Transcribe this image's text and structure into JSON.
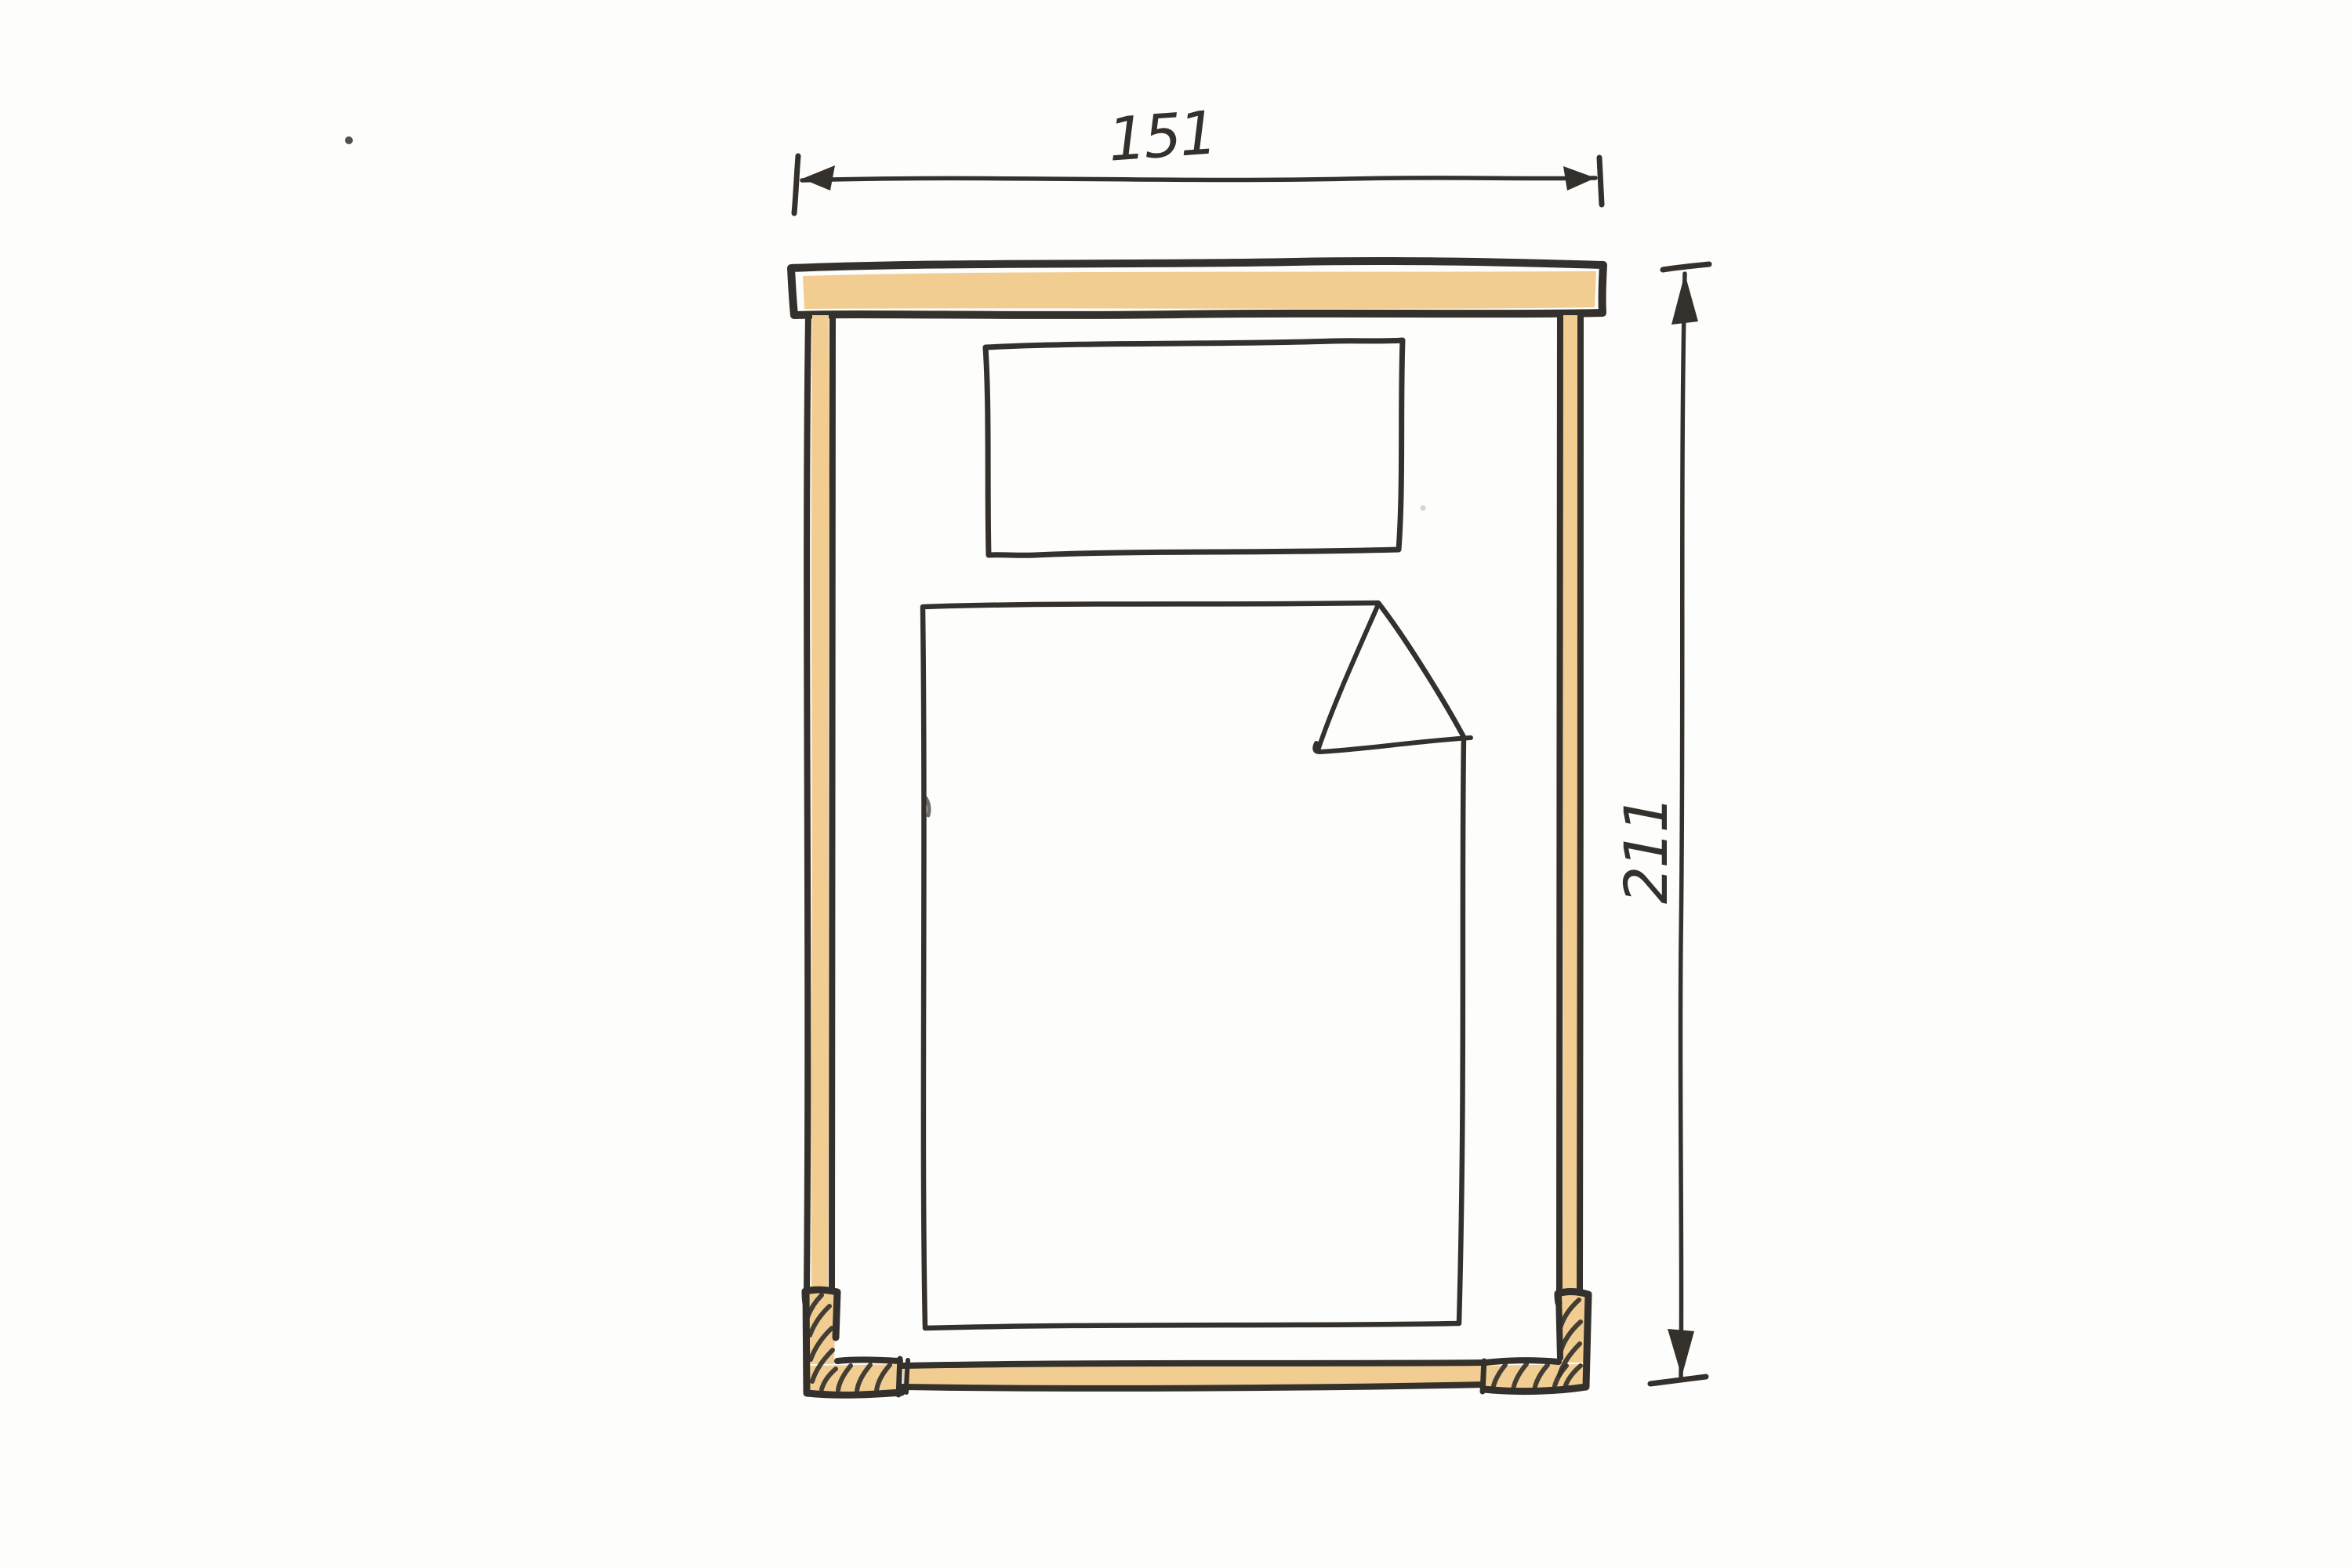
{
  "sketch": {
    "dimensions": {
      "width_label": "151",
      "height_label": "211"
    }
  },
  "colors": {
    "paper": "#fdfdfb",
    "ink": "#34312c",
    "wood": "#f2cd92"
  }
}
